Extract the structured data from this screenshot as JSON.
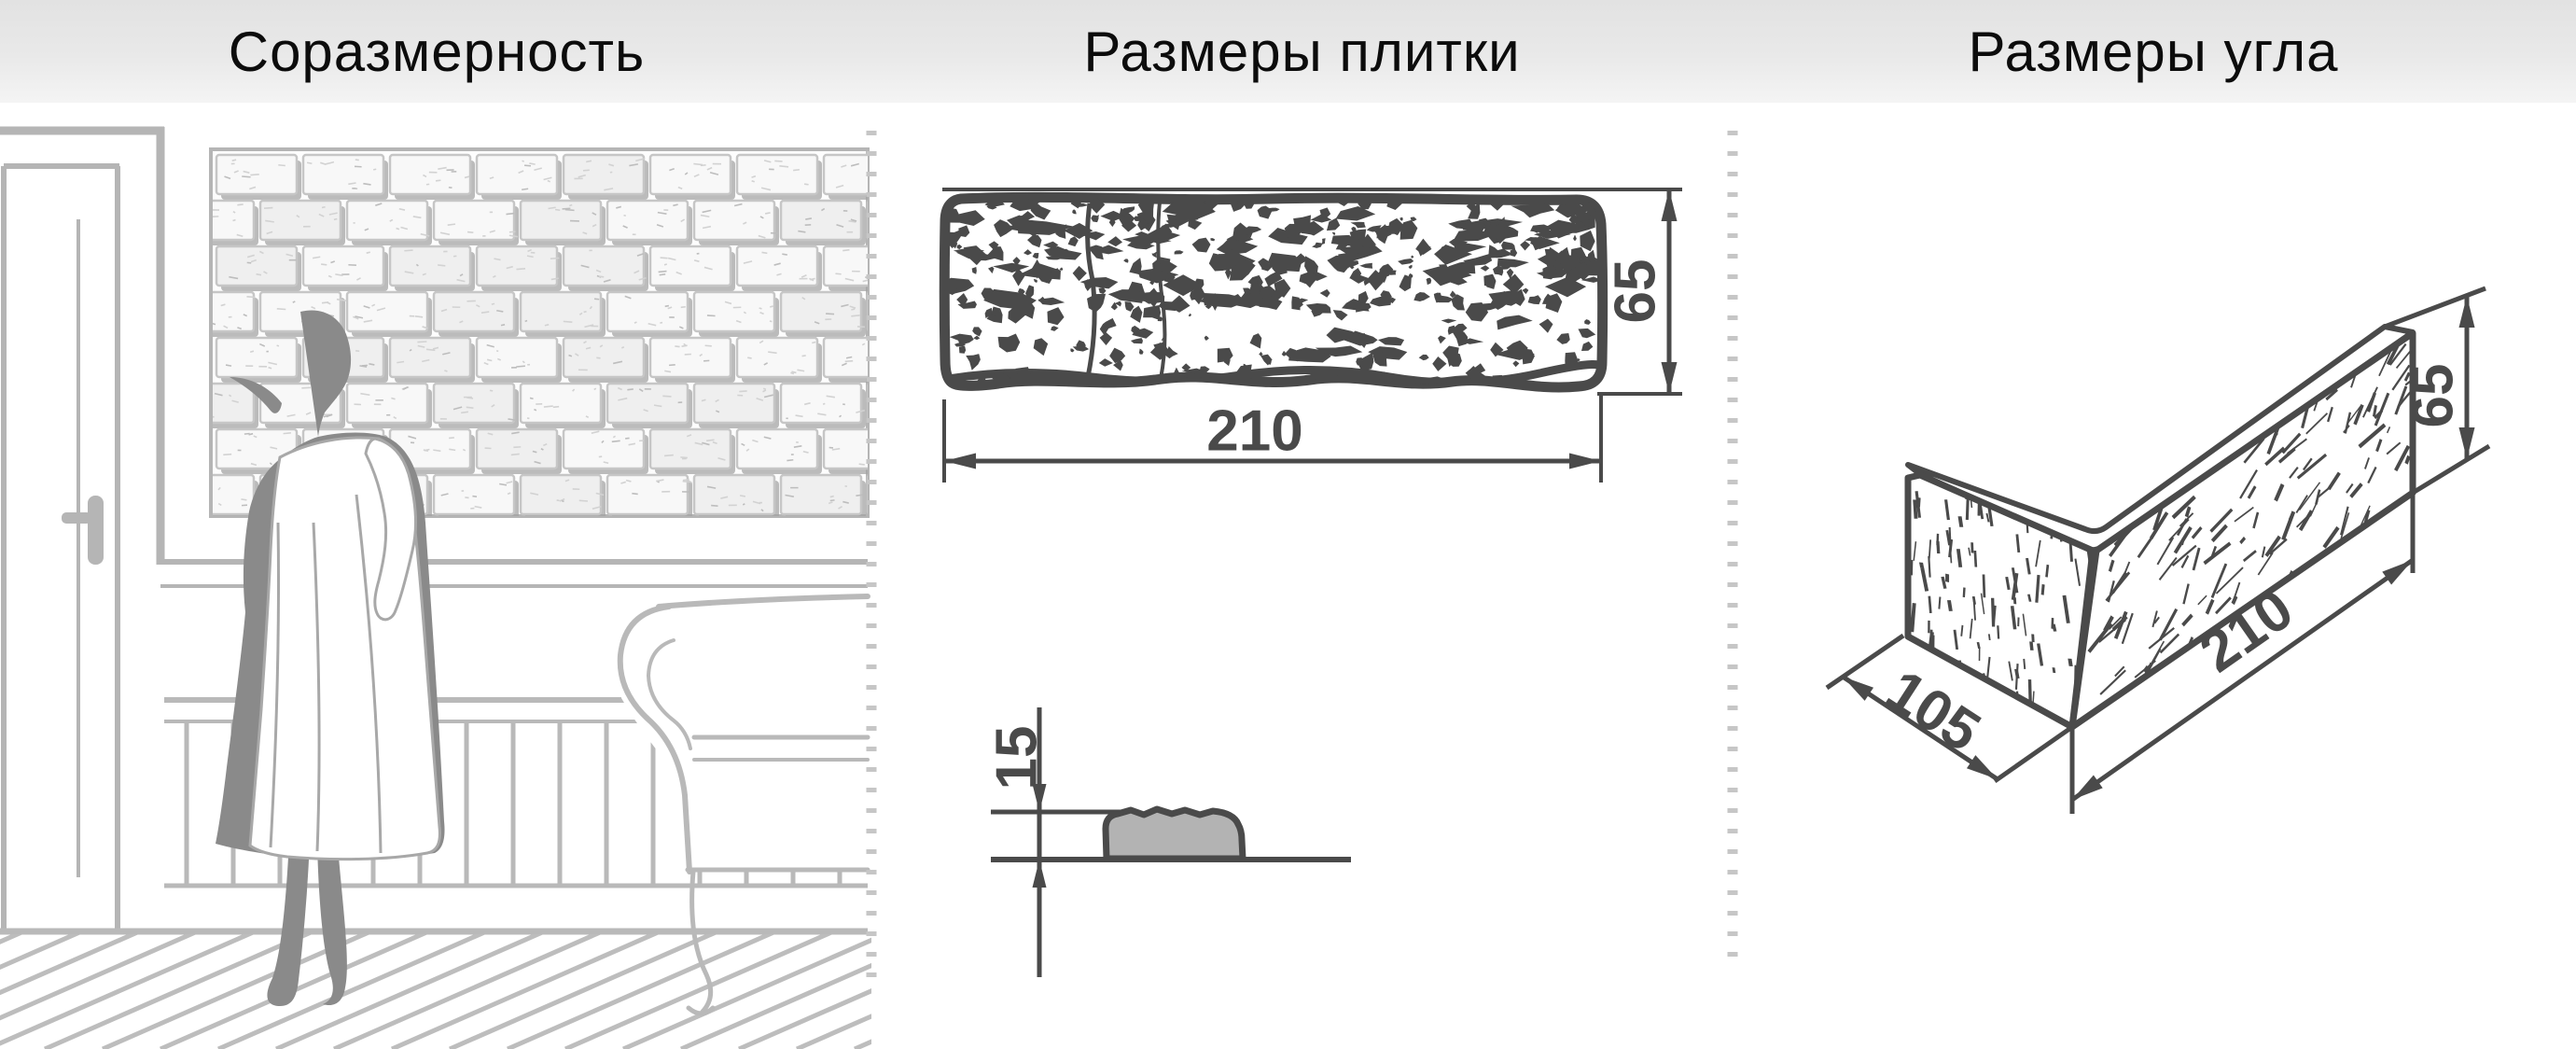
{
  "header": {
    "sections": [
      {
        "title": "Соразмерность"
      },
      {
        "title": "Размеры плитки"
      },
      {
        "title": "Размеры угла"
      }
    ]
  },
  "tile_view": {
    "width_mm": "210",
    "height_mm": "65",
    "thickness_mm": "15"
  },
  "corner_view": {
    "short_side_mm": "105",
    "long_side_mm": "210",
    "height_mm": "65"
  },
  "colors": {
    "drawing_dark": "#4a4a4a",
    "scene_light": "#b7b7b7",
    "figure_gray": "#8a8a8a",
    "section_fill": "#b3b3b3",
    "brick_stroke": "#c6c6c6",
    "brick_shadow": "#a4a4a4",
    "divider": "#c6c6c6",
    "header_text": "#0c0c0c"
  }
}
